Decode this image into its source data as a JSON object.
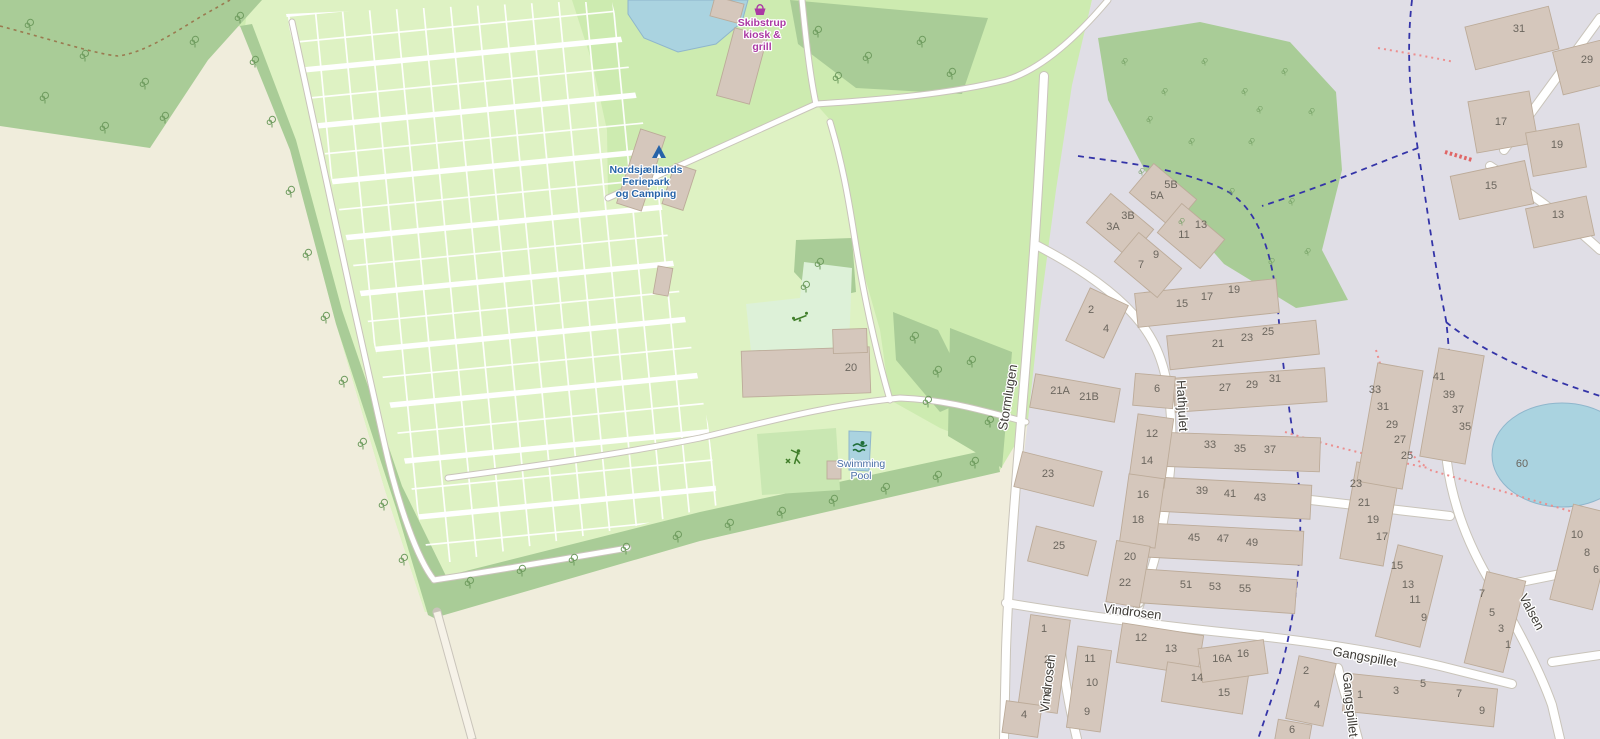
{
  "colors": {
    "farmland": "#f0eddc",
    "grass": "#cdebb0",
    "camp": "#def2c3",
    "forest": "#a9cc97",
    "residential": "#e0dee6",
    "water": "#aad3e0",
    "water_stroke": "#8fb6cc",
    "building": "#d5c7bc",
    "building_stroke": "#bcab99",
    "road_fill": "#ffffff",
    "road_casing": "#c9c4ba",
    "track": "#f6f2e8",
    "playground": "#ddf1d8",
    "sport_pitch": "#c9e7b2",
    "boundary_dash": "#3434a8",
    "footpath_dash": "#ec8f8f",
    "steps_dash": "#e06666",
    "track_dash": "#9a7a50",
    "house_num": "#6b665e",
    "street_name": "#3d3a35",
    "tree": "#6f9c5f",
    "camp_label": "#2663a8",
    "shop_label": "#ab39a4",
    "water_label": "#4a6fa5",
    "icon_green": "#3f7d29",
    "icon_swim": "#1f6e38",
    "tent_blue": "#2663a8"
  },
  "pois": {
    "camp": {
      "lines": [
        "Nordsjællands",
        "Feriepark",
        "og Camping"
      ]
    },
    "kiosk": {
      "lines": [
        "Skibstrup",
        "kiosk &",
        "grill"
      ]
    },
    "pool": {
      "lines": [
        "Swimming",
        "Pool"
      ]
    }
  },
  "streets": [
    {
      "name": "Stormlugen",
      "x": 1012,
      "y": 398,
      "rot": -81
    },
    {
      "name": "Hathjulet",
      "x": 1178,
      "y": 406,
      "rot": 87
    },
    {
      "name": "Vindrosen",
      "x": 1132,
      "y": 616,
      "rot": 7
    },
    {
      "name": "Vindrosen",
      "x": 1052,
      "y": 684,
      "rot": -83
    },
    {
      "name": "Gangspillet",
      "x": 1364,
      "y": 661,
      "rot": 10
    },
    {
      "name": "Gangspillet",
      "x": 1346,
      "y": 705,
      "rot": 84
    },
    {
      "name": "Valsen",
      "x": 1528,
      "y": 614,
      "rot": 62
    }
  ],
  "houses": [
    {
      "n": "3A",
      "x": 1113,
      "y": 230
    },
    {
      "n": "3B",
      "x": 1128,
      "y": 219
    },
    {
      "n": "5A",
      "x": 1157,
      "y": 199
    },
    {
      "n": "5B",
      "x": 1171,
      "y": 188
    },
    {
      "n": "7",
      "x": 1141,
      "y": 268
    },
    {
      "n": "9",
      "x": 1156,
      "y": 258
    },
    {
      "n": "11",
      "x": 1184,
      "y": 238
    },
    {
      "n": "13",
      "x": 1201,
      "y": 228
    },
    {
      "n": "15",
      "x": 1182,
      "y": 307
    },
    {
      "n": "17",
      "x": 1207,
      "y": 300
    },
    {
      "n": "19",
      "x": 1234,
      "y": 293
    },
    {
      "n": "21",
      "x": 1218,
      "y": 347
    },
    {
      "n": "23",
      "x": 1247,
      "y": 341
    },
    {
      "n": "25",
      "x": 1268,
      "y": 335
    },
    {
      "n": "27",
      "x": 1225,
      "y": 391
    },
    {
      "n": "29",
      "x": 1252,
      "y": 388
    },
    {
      "n": "31",
      "x": 1275,
      "y": 382
    },
    {
      "n": "33",
      "x": 1210,
      "y": 448
    },
    {
      "n": "35",
      "x": 1240,
      "y": 452
    },
    {
      "n": "37",
      "x": 1270,
      "y": 453
    },
    {
      "n": "39",
      "x": 1202,
      "y": 494
    },
    {
      "n": "41",
      "x": 1230,
      "y": 497
    },
    {
      "n": "43",
      "x": 1260,
      "y": 501
    },
    {
      "n": "45",
      "x": 1194,
      "y": 541
    },
    {
      "n": "47",
      "x": 1223,
      "y": 542
    },
    {
      "n": "49",
      "x": 1252,
      "y": 546
    },
    {
      "n": "51",
      "x": 1186,
      "y": 588
    },
    {
      "n": "53",
      "x": 1215,
      "y": 590
    },
    {
      "n": "55",
      "x": 1245,
      "y": 592
    },
    {
      "n": "2",
      "x": 1091,
      "y": 313
    },
    {
      "n": "4",
      "x": 1106,
      "y": 332
    },
    {
      "n": "21A",
      "x": 1060,
      "y": 394
    },
    {
      "n": "21B",
      "x": 1089,
      "y": 400
    },
    {
      "n": "23",
      "x": 1048,
      "y": 477
    },
    {
      "n": "25",
      "x": 1059,
      "y": 549
    },
    {
      "n": "6",
      "x": 1157,
      "y": 392
    },
    {
      "n": "12",
      "x": 1152,
      "y": 437
    },
    {
      "n": "14",
      "x": 1147,
      "y": 464
    },
    {
      "n": "16",
      "x": 1143,
      "y": 498
    },
    {
      "n": "18",
      "x": 1138,
      "y": 523
    },
    {
      "n": "20",
      "x": 1130,
      "y": 560
    },
    {
      "n": "22",
      "x": 1125,
      "y": 586
    },
    {
      "n": "1",
      "x": 1044,
      "y": 632
    },
    {
      "n": "2",
      "x": 1047,
      "y": 663
    },
    {
      "n": "3",
      "x": 1047,
      "y": 695
    },
    {
      "n": "4",
      "x": 1024,
      "y": 718
    },
    {
      "n": "11",
      "x": 1090,
      "y": 662
    },
    {
      "n": "10",
      "x": 1092,
      "y": 686
    },
    {
      "n": "9",
      "x": 1087,
      "y": 715
    },
    {
      "n": "12",
      "x": 1141,
      "y": 641
    },
    {
      "n": "13",
      "x": 1171,
      "y": 652
    },
    {
      "n": "14",
      "x": 1197,
      "y": 681
    },
    {
      "n": "15",
      "x": 1224,
      "y": 696
    },
    {
      "n": "16A",
      "x": 1222,
      "y": 662
    },
    {
      "n": "16",
      "x": 1243,
      "y": 657
    },
    {
      "n": "2",
      "x": 1306,
      "y": 674
    },
    {
      "n": "4",
      "x": 1317,
      "y": 708
    },
    {
      "n": "6",
      "x": 1292,
      "y": 733
    },
    {
      "n": "31",
      "x": 1519,
      "y": 32
    },
    {
      "n": "29",
      "x": 1587,
      "y": 63
    },
    {
      "n": "17",
      "x": 1501,
      "y": 125
    },
    {
      "n": "19",
      "x": 1557,
      "y": 148
    },
    {
      "n": "15",
      "x": 1491,
      "y": 189
    },
    {
      "n": "13",
      "x": 1558,
      "y": 218
    },
    {
      "n": "33",
      "x": 1375,
      "y": 393
    },
    {
      "n": "31",
      "x": 1383,
      "y": 410
    },
    {
      "n": "29",
      "x": 1392,
      "y": 428
    },
    {
      "n": "27",
      "x": 1400,
      "y": 443
    },
    {
      "n": "25",
      "x": 1407,
      "y": 459
    },
    {
      "n": "41",
      "x": 1439,
      "y": 380
    },
    {
      "n": "39",
      "x": 1449,
      "y": 398
    },
    {
      "n": "37",
      "x": 1458,
      "y": 413
    },
    {
      "n": "35",
      "x": 1465,
      "y": 430
    },
    {
      "n": "23",
      "x": 1356,
      "y": 487
    },
    {
      "n": "21",
      "x": 1364,
      "y": 506
    },
    {
      "n": "19",
      "x": 1373,
      "y": 523
    },
    {
      "n": "17",
      "x": 1382,
      "y": 540
    },
    {
      "n": "15",
      "x": 1397,
      "y": 569
    },
    {
      "n": "13",
      "x": 1408,
      "y": 588
    },
    {
      "n": "11",
      "x": 1415,
      "y": 603
    },
    {
      "n": "9",
      "x": 1424,
      "y": 621
    },
    {
      "n": "7",
      "x": 1482,
      "y": 597
    },
    {
      "n": "5",
      "x": 1492,
      "y": 616
    },
    {
      "n": "3",
      "x": 1501,
      "y": 632
    },
    {
      "n": "1",
      "x": 1508,
      "y": 648
    },
    {
      "n": "10",
      "x": 1577,
      "y": 538
    },
    {
      "n": "8",
      "x": 1587,
      "y": 556
    },
    {
      "n": "6",
      "x": 1596,
      "y": 573
    },
    {
      "n": "1",
      "x": 1360,
      "y": 698
    },
    {
      "n": "3",
      "x": 1396,
      "y": 694
    },
    {
      "n": "5",
      "x": 1423,
      "y": 687
    },
    {
      "n": "7",
      "x": 1459,
      "y": 697
    },
    {
      "n": "9",
      "x": 1482,
      "y": 714
    },
    {
      "n": "20",
      "x": 851,
      "y": 371
    },
    {
      "n": "60",
      "x": 1522,
      "y": 467
    }
  ],
  "buildings": [
    [
      1207,
      303,
      142,
      34,
      -6
    ],
    [
      1243,
      345,
      150,
      34,
      -6
    ],
    [
      1250,
      390,
      152,
      34,
      -4
    ],
    [
      1239,
      452,
      162,
      34,
      2
    ],
    [
      1230,
      498,
      162,
      34,
      3
    ],
    [
      1222,
      544,
      162,
      34,
      3
    ],
    [
      1215,
      591,
      162,
      34,
      4
    ],
    [
      1120,
      226,
      56,
      38,
      40
    ],
    [
      1163,
      196,
      56,
      38,
      40
    ],
    [
      1148,
      265,
      56,
      38,
      40
    ],
    [
      1191,
      236,
      56,
      38,
      40
    ],
    [
      1097,
      323,
      42,
      58,
      25
    ],
    [
      1075,
      398,
      86,
      34,
      10
    ],
    [
      1058,
      479,
      82,
      36,
      14
    ],
    [
      1062,
      551,
      62,
      36,
      14
    ],
    [
      1154,
      391,
      40,
      32,
      5
    ],
    [
      1151,
      451,
      36,
      70,
      8
    ],
    [
      1142,
      511,
      36,
      70,
      8
    ],
    [
      1128,
      574,
      34,
      62,
      10
    ],
    [
      1044,
      664,
      40,
      94,
      8
    ],
    [
      1022,
      719,
      36,
      32,
      8
    ],
    [
      1089,
      689,
      34,
      82,
      8
    ],
    [
      1160,
      649,
      82,
      40,
      9
    ],
    [
      1205,
      688,
      82,
      40,
      9
    ],
    [
      1233,
      661,
      66,
      34,
      -8
    ],
    [
      1311,
      691,
      38,
      64,
      12
    ],
    [
      1293,
      734,
      34,
      24,
      10
    ],
    [
      1583,
      557,
      44,
      98,
      14
    ],
    [
      1420,
      700,
      152,
      38,
      6
    ],
    [
      1495,
      622,
      40,
      94,
      14
    ],
    [
      1512,
      38,
      86,
      44,
      -14
    ],
    [
      1588,
      66,
      62,
      44,
      -14
    ],
    [
      1503,
      122,
      62,
      52,
      -10
    ],
    [
      1556,
      150,
      54,
      44,
      -10
    ],
    [
      1492,
      190,
      76,
      44,
      -12
    ],
    [
      1560,
      222,
      62,
      40,
      -12
    ],
    [
      1409,
      596,
      46,
      94,
      14
    ],
    [
      1370,
      514,
      44,
      98,
      10
    ],
    [
      1390,
      426,
      46,
      120,
      10
    ],
    [
      1452,
      406,
      46,
      110,
      10
    ],
    [
      742,
      66,
      34,
      70,
      15
    ],
    [
      727,
      10,
      30,
      20,
      15
    ],
    [
      641,
      170,
      26,
      78,
      18
    ],
    [
      679,
      187,
      22,
      42,
      18
    ],
    [
      806,
      372,
      128,
      46,
      -2
    ],
    [
      850,
      341,
      34,
      24,
      -2
    ],
    [
      834,
      470,
      14,
      18,
      0
    ],
    [
      663,
      281,
      15,
      28,
      10
    ]
  ],
  "trees": [
    [
      255,
      62
    ],
    [
      272,
      122
    ],
    [
      291,
      192
    ],
    [
      308,
      255
    ],
    [
      326,
      318
    ],
    [
      344,
      382
    ],
    [
      363,
      444
    ],
    [
      384,
      505
    ],
    [
      404,
      560
    ],
    [
      470,
      583
    ],
    [
      522,
      571
    ],
    [
      574,
      560
    ],
    [
      626,
      549
    ],
    [
      678,
      537
    ],
    [
      730,
      525
    ],
    [
      782,
      513
    ],
    [
      834,
      501
    ],
    [
      886,
      489
    ],
    [
      938,
      477
    ],
    [
      975,
      463
    ],
    [
      30,
      25
    ],
    [
      85,
      56
    ],
    [
      145,
      84
    ],
    [
      45,
      98
    ],
    [
      105,
      128
    ],
    [
      195,
      42
    ],
    [
      240,
      18
    ],
    [
      165,
      118
    ],
    [
      818,
      32
    ],
    [
      868,
      58
    ],
    [
      922,
      42
    ],
    [
      952,
      74
    ],
    [
      838,
      78
    ],
    [
      820,
      264
    ],
    [
      806,
      287
    ],
    [
      915,
      338
    ],
    [
      938,
      372
    ],
    [
      928,
      402
    ],
    [
      972,
      362
    ],
    [
      990,
      422
    ]
  ],
  "scrub": [
    [
      1125,
      62
    ],
    [
      1165,
      92
    ],
    [
      1205,
      62
    ],
    [
      1245,
      92
    ],
    [
      1285,
      72
    ],
    [
      1312,
      112
    ],
    [
      1252,
      142
    ],
    [
      1192,
      142
    ],
    [
      1142,
      172
    ],
    [
      1232,
      192
    ],
    [
      1292,
      202
    ],
    [
      1308,
      252
    ],
    [
      1272,
      262
    ],
    [
      1182,
      222
    ],
    [
      1150,
      120
    ],
    [
      1260,
      110
    ]
  ]
}
